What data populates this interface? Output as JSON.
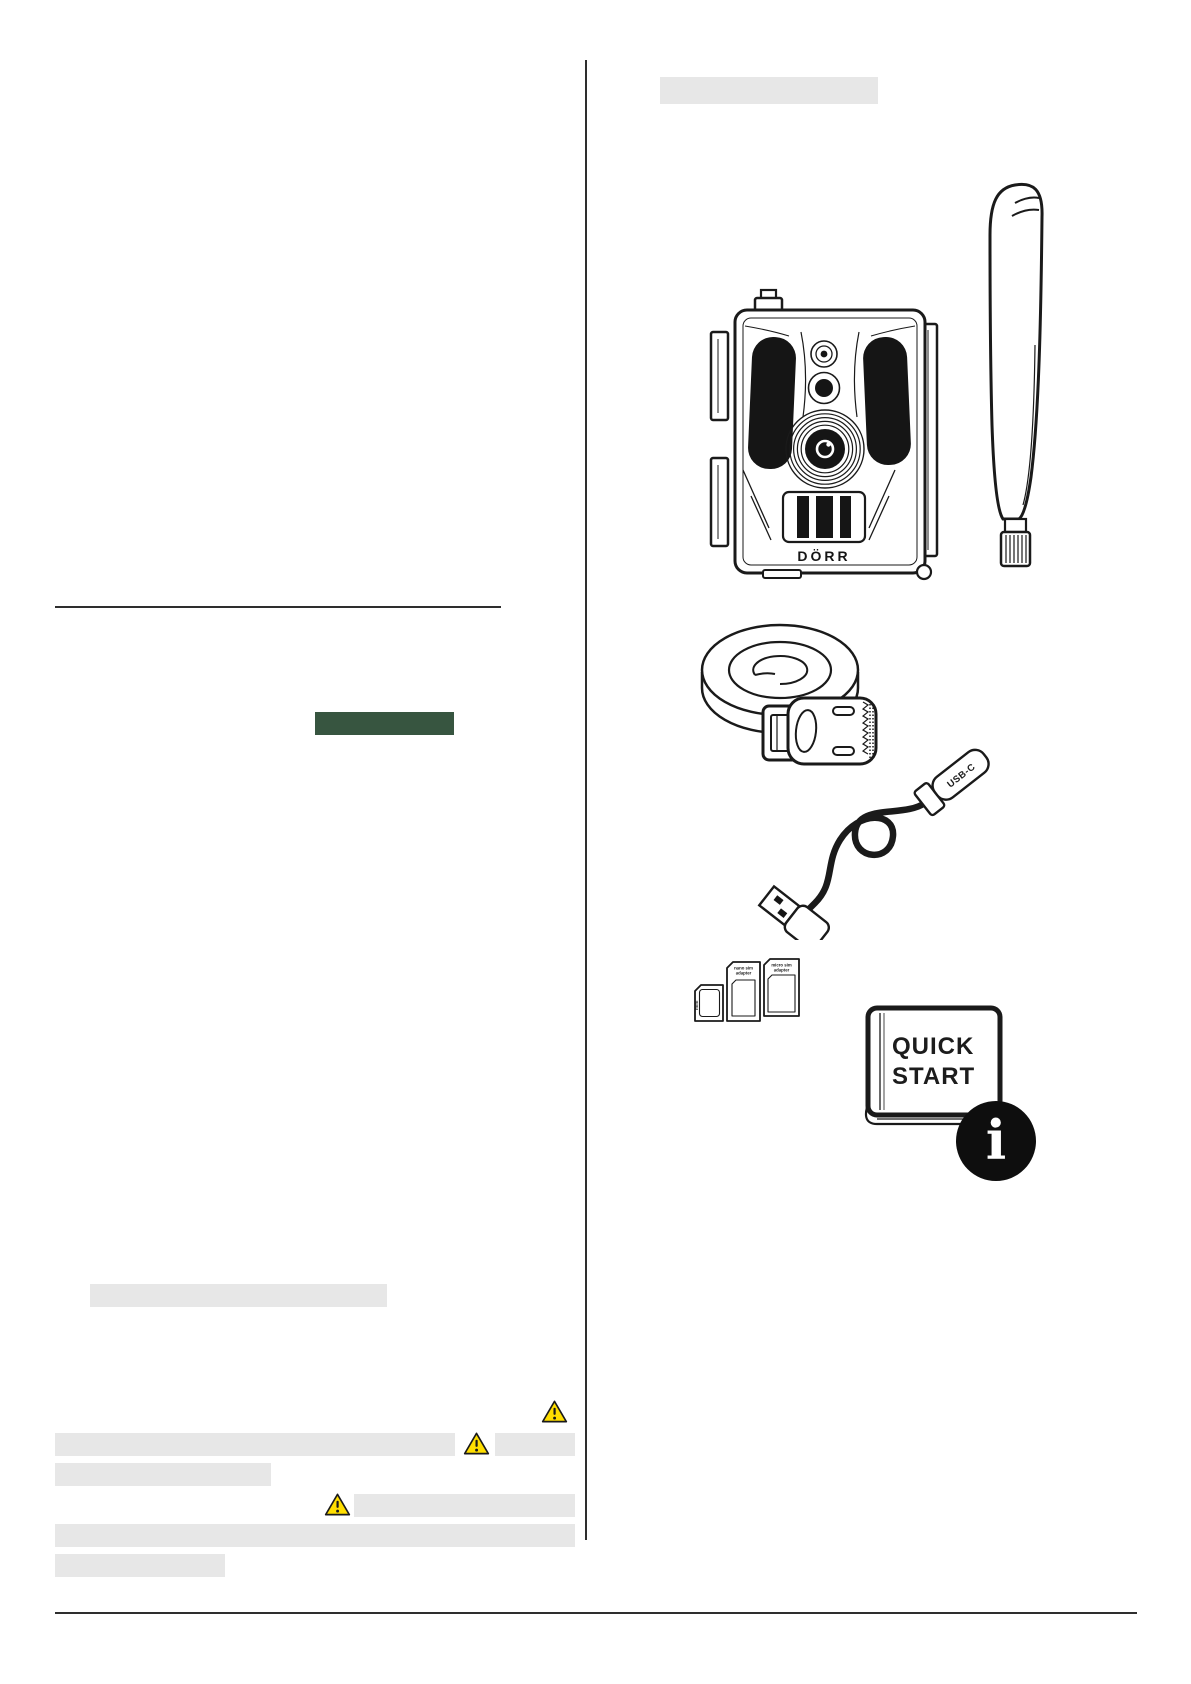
{
  "page": {
    "background": "#FFFFFF",
    "ink_color": "#1A1A1A",
    "placeholder_bar_color": "#E7E7E7",
    "highlight_green": "#375540",
    "warning_yellow": "#FFDE00",
    "info_badge_black": "#0E0E0E"
  },
  "icons": {
    "warning_triangle_icon": "⚠",
    "info_icon": "ℹ"
  },
  "illustrations": {
    "camera": {
      "brand_label": "DÖRR"
    },
    "usb_cable": {
      "connector_label": "USB-C"
    },
    "sim_adapters": {
      "mini_label": "mini",
      "nano_line1": "nano sim",
      "nano_line2": "adapter",
      "micro_line1": "micro sim",
      "micro_line2": "adapter"
    },
    "quick_start_guide": {
      "title_line1": "QUICK",
      "title_line2": "START",
      "info_glyph": "i"
    }
  }
}
